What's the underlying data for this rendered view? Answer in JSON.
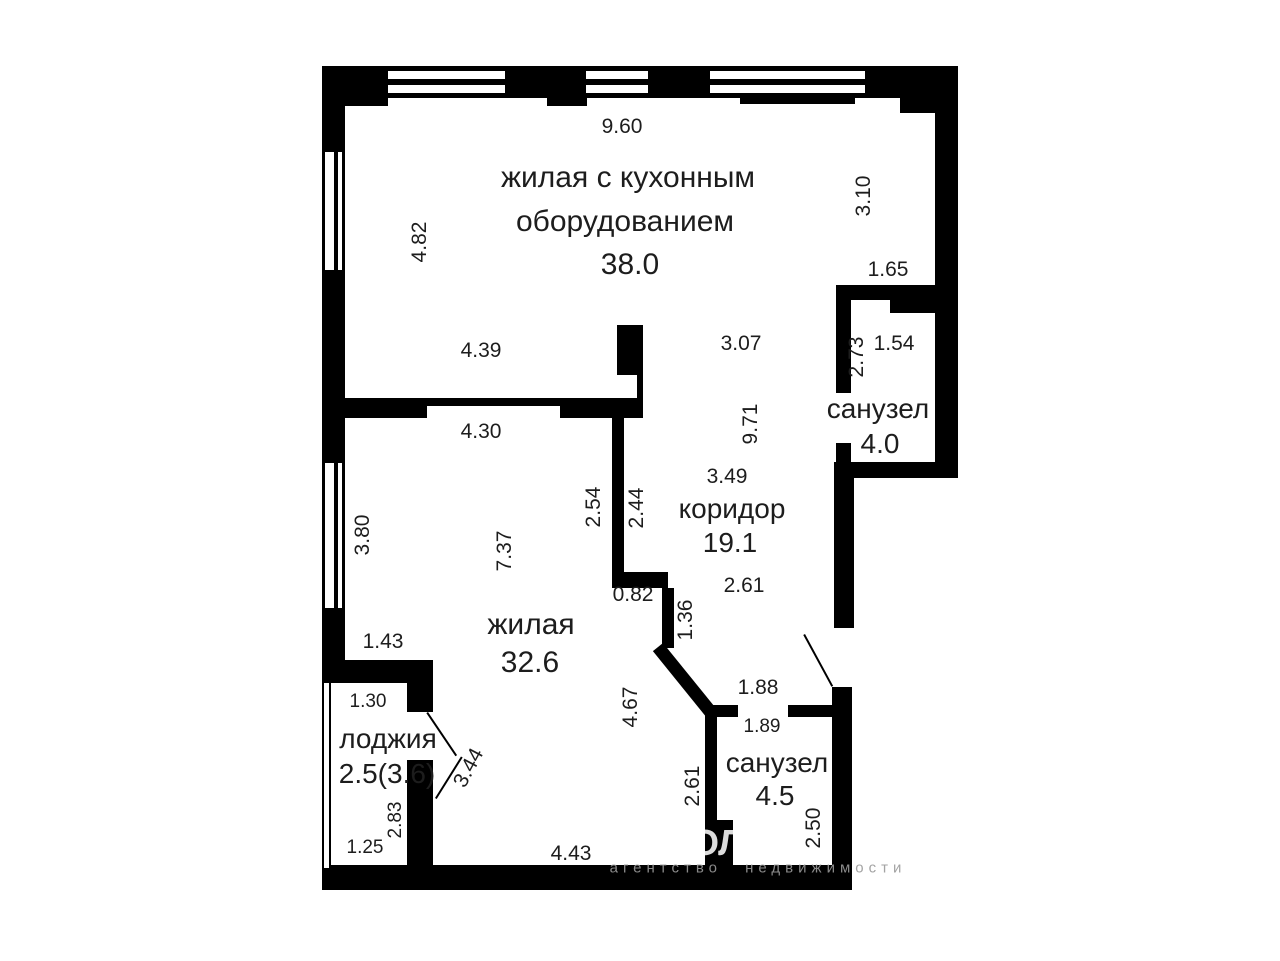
{
  "rooms": {
    "kitchen_living": {
      "name_line1": "жилая с кухонным",
      "name_line2": "оборудованием",
      "area": "38.0"
    },
    "bathroom_upper": {
      "name": "санузел",
      "area": "4.0"
    },
    "corridor": {
      "name": "коридор",
      "area": "19.1"
    },
    "living": {
      "name": "жилая",
      "area": "32.6"
    },
    "loggia": {
      "name": "лоджия",
      "area": "2.5(3.6)"
    },
    "bathroom_lower": {
      "name": "санузел",
      "area": "4.5"
    }
  },
  "dimensions": {
    "d960": "9.60",
    "d482": "4.82",
    "d310": "3.10",
    "d165": "1.65",
    "d273": "2.73",
    "d154": "1.54",
    "d439": "4.39",
    "d307": "3.07",
    "d971": "9.71",
    "d430": "4.30",
    "d349": "3.49",
    "d254": "2.54",
    "d244": "2.44",
    "d380": "3.80",
    "d737": "7.37",
    "d082": "0.82",
    "d136": "1.36",
    "d261_corridor": "2.61",
    "d143": "1.43",
    "d467": "4.67",
    "d188": "1.88",
    "d189": "1.89",
    "d261_bath": "2.61",
    "d250": "2.50",
    "d130": "1.30",
    "d344": "3.44",
    "d283": "2.83",
    "d125": "1.25",
    "d443": "4.43"
  },
  "watermark": {
    "logo_fragment": "ОЛ",
    "caption": "агентство недвижимости"
  },
  "colors": {
    "wall": "#000000",
    "background": "#ffffff",
    "text": "#1d1d1d",
    "watermark": "#9a9a9a"
  }
}
